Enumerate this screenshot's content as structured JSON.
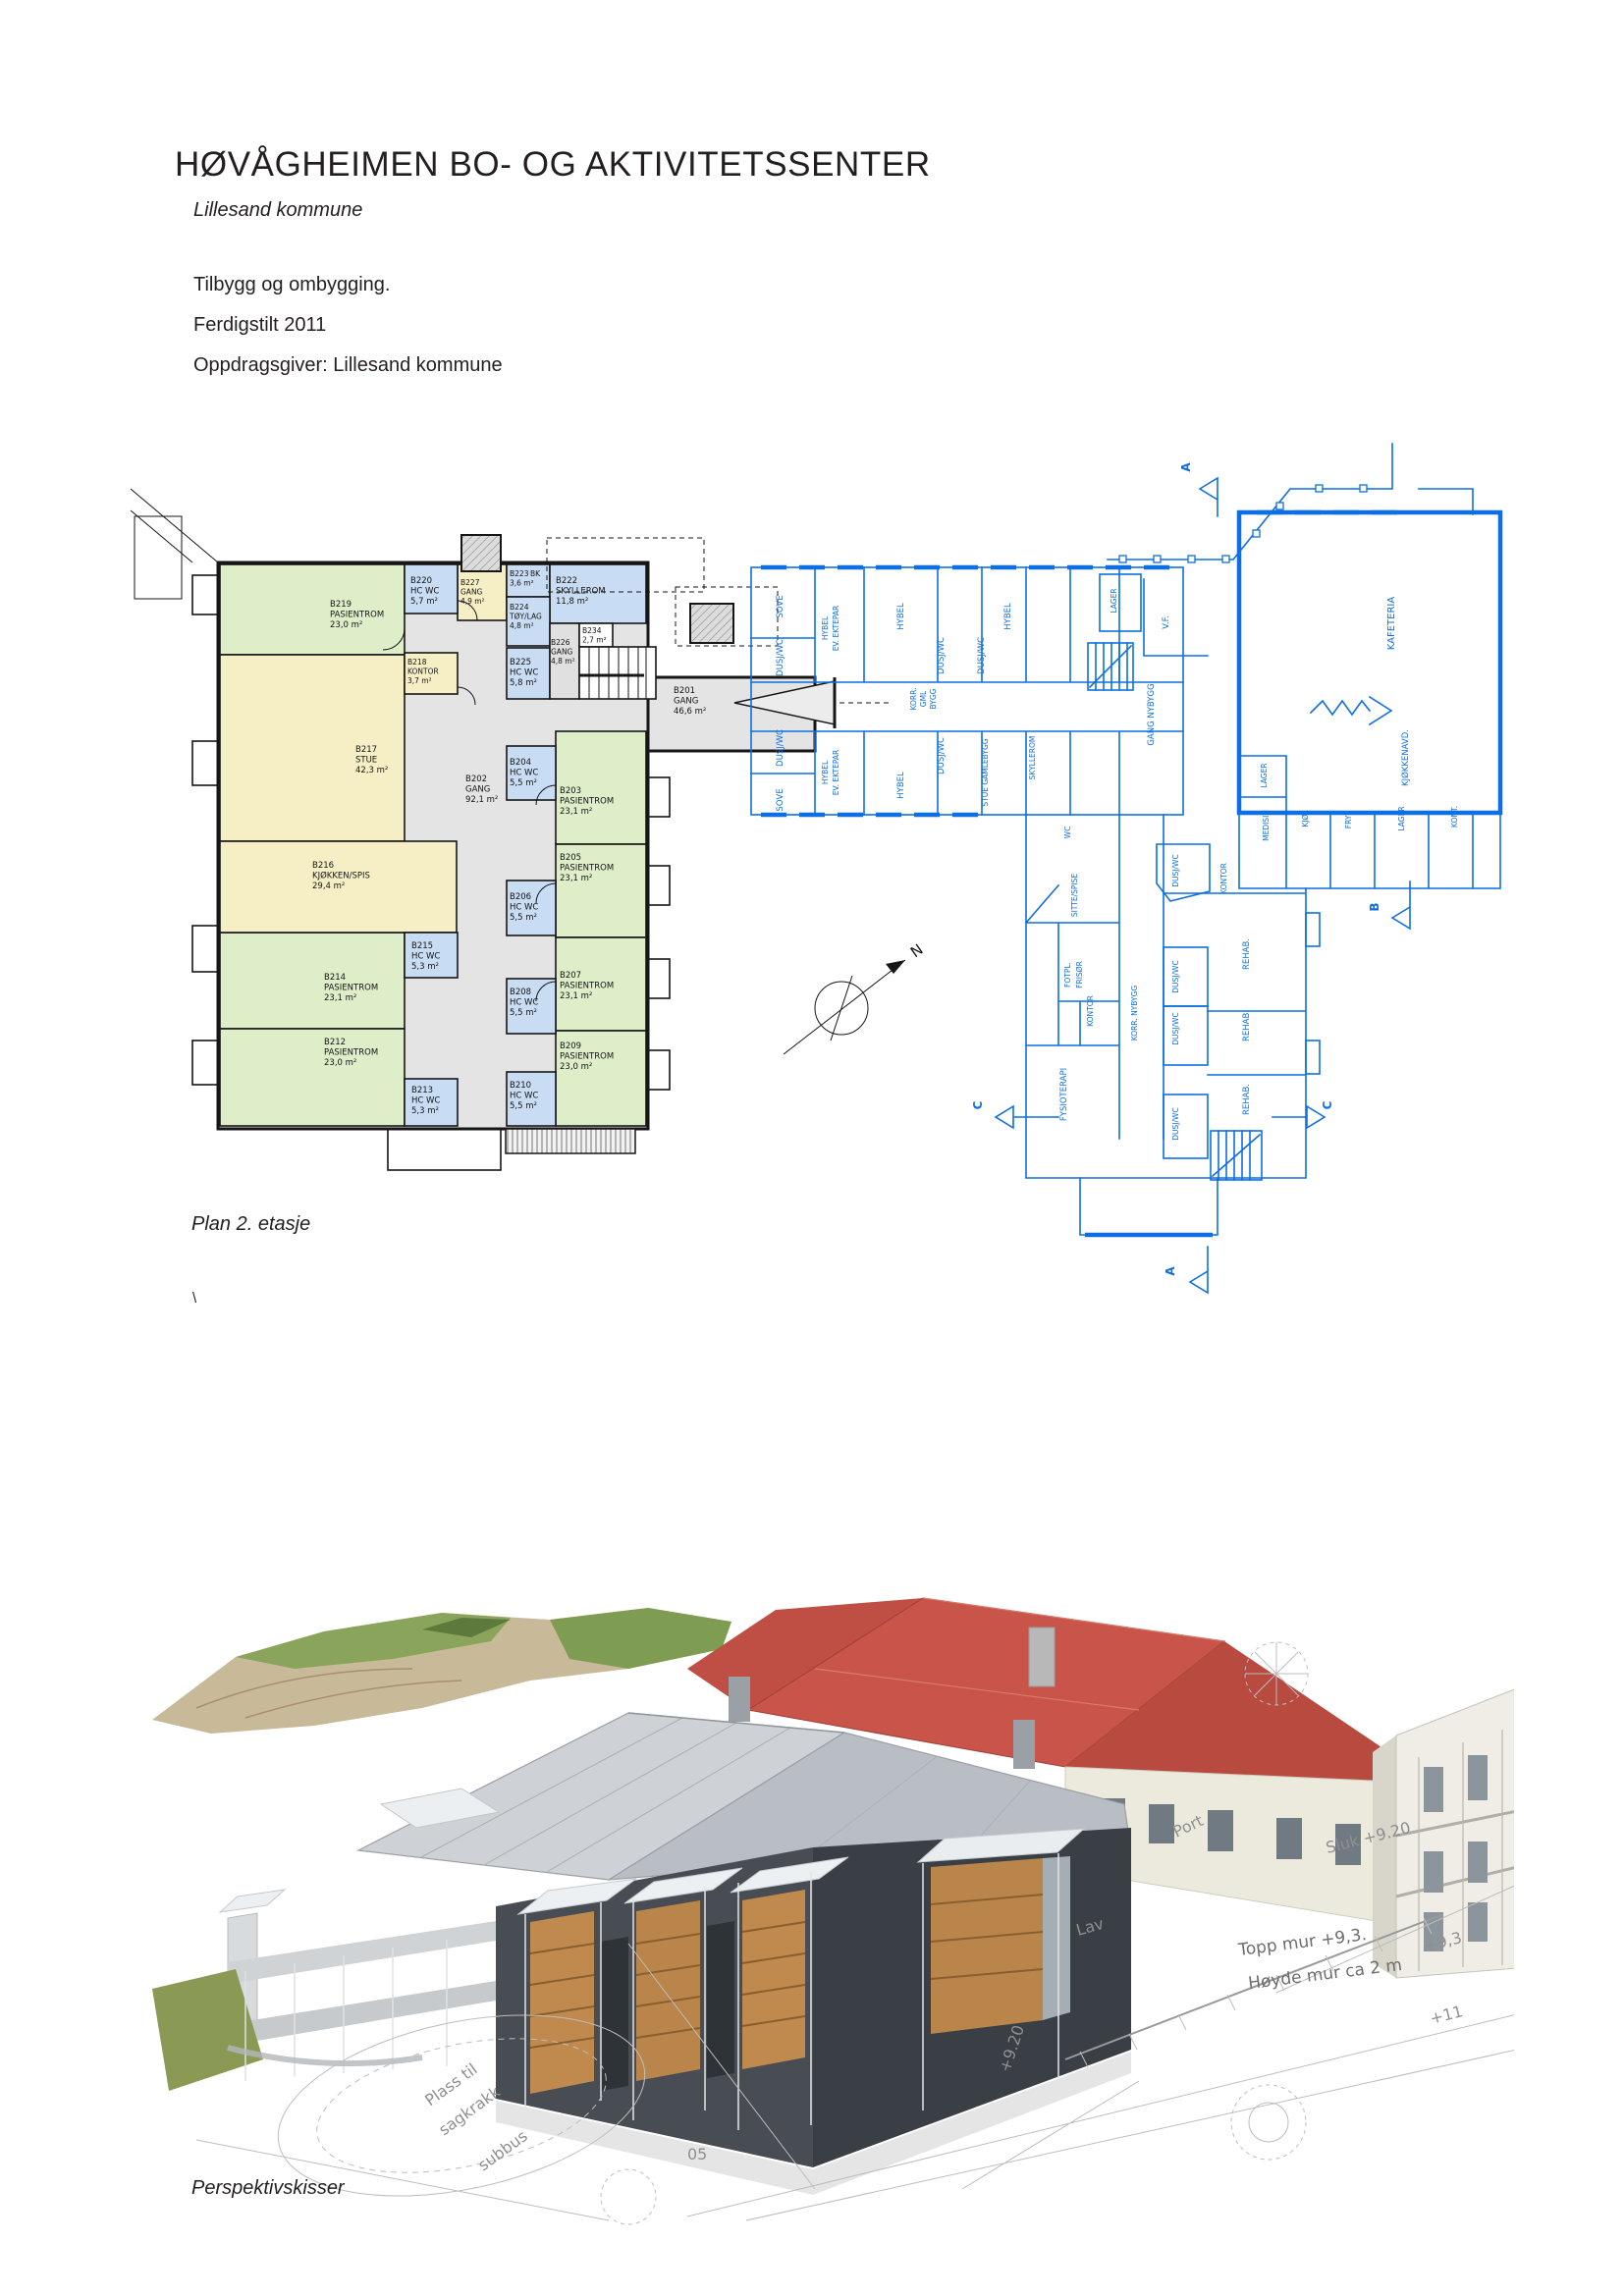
{
  "header": {
    "title": "HØVÅGHEIMEN BO- OG AKTIVITETSSENTER",
    "subtitle": "Lillesand kommune",
    "line1": "Tilbygg og ombygging.",
    "line2": "Ferdigstilt 2011",
    "line3": "Oppdragsgiver: Lillesand kommune"
  },
  "captions": {
    "plan": "Plan 2. etasje",
    "perspective": "Perspektivskisser",
    "stray_mark": "\\"
  },
  "plan": {
    "north": "N",
    "marks": {
      "a": "A",
      "b": "B",
      "c": "C"
    },
    "rooms": [
      {
        "id": "B219",
        "name": "PASIENTROM",
        "area": "23,0 m²"
      },
      {
        "id": "B220",
        "name": "HC WC",
        "area": "5,7 m²"
      },
      {
        "id": "B227",
        "name": "GANG",
        "area": "4,9 m²"
      },
      {
        "id": "B223",
        "name": "BK",
        "area": "3,6 m²"
      },
      {
        "id": "B222",
        "name": "SKYLLEROM",
        "area": "11,8 m²"
      },
      {
        "id": "B224",
        "name": "TØY/LAG",
        "area": "4,8 m²"
      },
      {
        "id": "B225",
        "name": "HC WC",
        "area": "5,8 m²"
      },
      {
        "id": "B226",
        "name": "GANG",
        "area": "4,8 m²"
      },
      {
        "id": "B234",
        "name": "",
        "area": "2,7 m²"
      },
      {
        "id": "B218",
        "name": "KONTOR",
        "area": "3,7 m²"
      },
      {
        "id": "B217",
        "name": "STUE",
        "area": "42,3 m²"
      },
      {
        "id": "B216",
        "name": "KJØKKEN/SPIS",
        "area": "29,4 m²"
      },
      {
        "id": "B215",
        "name": "HC WC",
        "area": "5,3 m²"
      },
      {
        "id": "B214",
        "name": "PASIENTROM",
        "area": "23,1 m²"
      },
      {
        "id": "B212",
        "name": "PASIENTROM",
        "area": "23,0 m²"
      },
      {
        "id": "B213",
        "name": "HC WC",
        "area": "5,3 m²"
      },
      {
        "id": "B202",
        "name": "GANG",
        "area": "92,1 m²"
      },
      {
        "id": "B203",
        "name": "PASIENTROM",
        "area": "23,1 m²"
      },
      {
        "id": "B204",
        "name": "HC WC",
        "area": "5,5 m²"
      },
      {
        "id": "B205",
        "name": "PASIENTROM",
        "area": "23,1 m²"
      },
      {
        "id": "B206",
        "name": "HC WC",
        "area": "5,5 m²"
      },
      {
        "id": "B207",
        "name": "PASIENTROM",
        "area": "23,1 m²"
      },
      {
        "id": "B208",
        "name": "HC WC",
        "area": "5,5 m²"
      },
      {
        "id": "B209",
        "name": "PASIENTROM",
        "area": "23,0 m²"
      },
      {
        "id": "B210",
        "name": "HC WC",
        "area": "5,5 m²"
      },
      {
        "id": "B201",
        "name": "GANG",
        "area": "46,6 m²"
      }
    ],
    "labels": {
      "sove": "SOVE",
      "d_wc": "DUSJ/WC",
      "hybel": "HYBEL",
      "ev_ektepar": "EV. EKTEPAR",
      "korr": "KORR.",
      "gml": "GML",
      "bygg": "BYGG",
      "stue_gamlebygg": "STUE GAMLEBYGG",
      "skyllerom": "SKYLLEROM",
      "lager": "LAGER",
      "vf": "V.F.",
      "kafeteria": "KAFETERIA",
      "gang_nybygg": "GANG NYBYGG",
      "kjokkenavd": "KJØKKENAVD.",
      "medisin": "MEDISIN",
      "kjol": "KJØL",
      "frys": "FRYS",
      "kont": "KONT.",
      "kontor": "KONTOR",
      "wc": "WC",
      "sitte_spise": "SITTE/SPISE",
      "fotpl": "FOTPL.",
      "frisor": "FRISØR",
      "korr_nybygg": "KORR. NYBYGG",
      "rehab": "REHAB.",
      "fysioterapi": "FYSIOTERAPI"
    }
  },
  "perspective_notes": {
    "port": "Port",
    "sluk": "Sluk +9.20",
    "lav": "Lav",
    "n920": "+9.20",
    "n05": "05",
    "n93": "+9,3",
    "n11": "+11",
    "topp_mur": "Topp mur +9,3.",
    "hoyde_mur": "Høyde mur ca 2 m",
    "plass_til": "Plass til",
    "sagkrakk": "sagkrakk",
    "subbus": "subbus"
  },
  "colors": {
    "blueprint_blue": "#0d6fe2",
    "room_green": "#ddeec9",
    "room_blue": "#c8dcf4",
    "room_yellow": "#f6efc5",
    "corridor_gray": "#e4e4e4",
    "roof_red": "#c9554a",
    "wall_charcoal": "#474d53",
    "roof_gray": "#c6cace",
    "ink": "#231f20"
  }
}
